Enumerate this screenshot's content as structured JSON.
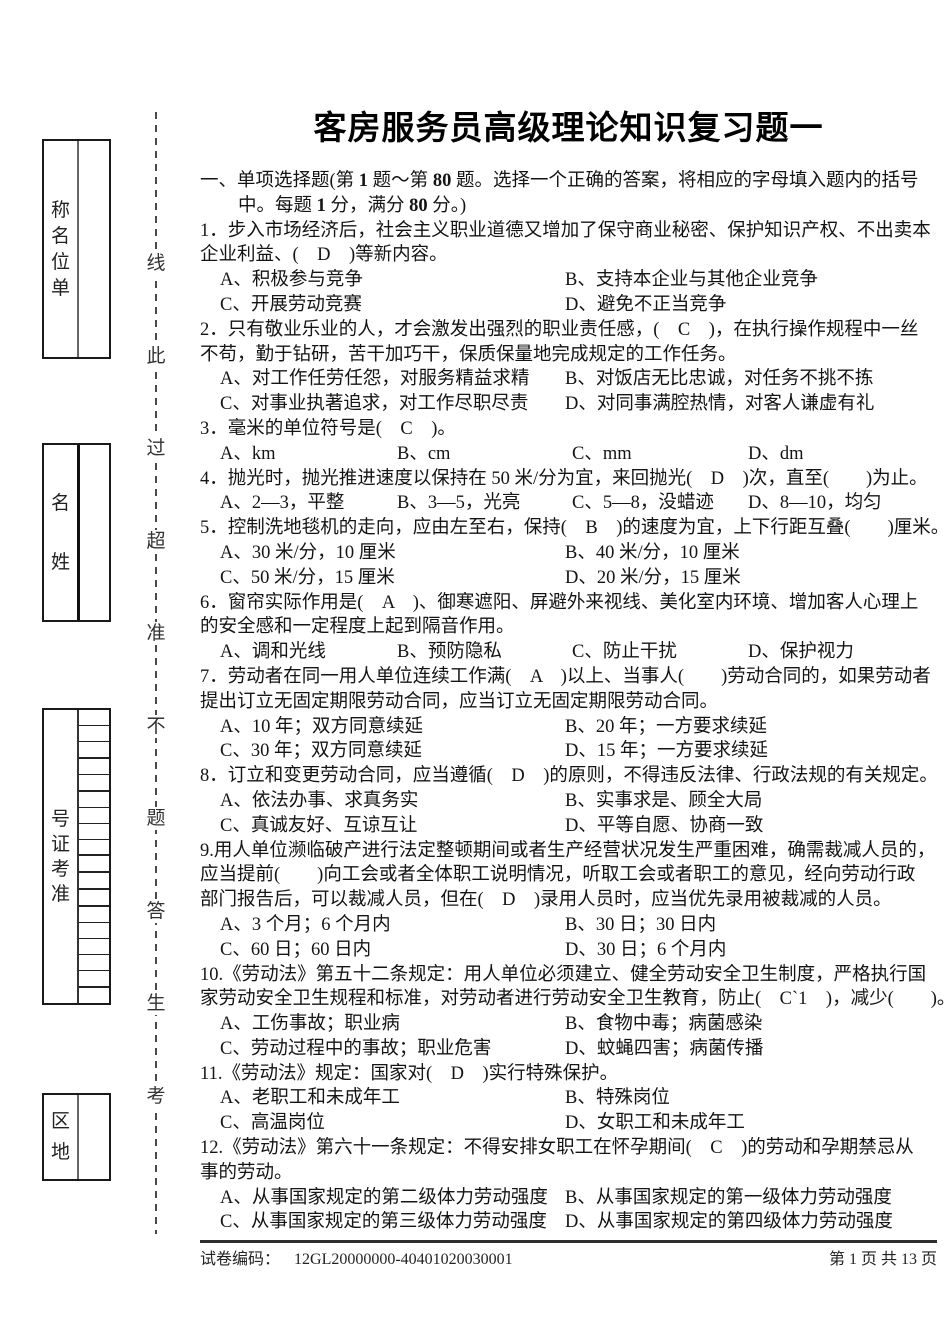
{
  "page": {
    "title": "客房服务员高级理论知识复习题一"
  },
  "section_header": {
    "line1": "一、单项选择题(第 1 题～第 80 题。选择一个正确的答案，将相应的字母填入题内的括号",
    "line2": "中。每题 1 分，满分 80 分。)"
  },
  "questions": [
    {
      "layout": "two",
      "stem_lines": [
        "1．步入市场经济后，社会主义职业道德又增加了保守商业秘密、保护知识产权、不出卖本",
        "企业利益、(　D　)等新内容。"
      ],
      "options": [
        "A、积极参与竞争",
        "B、支持本企业与其他企业竞争",
        "C、开展劳动竞赛",
        "D、避免不正当竞争"
      ]
    },
    {
      "layout": "two",
      "stem_lines": [
        "2．只有敬业乐业的人，才会激发出强烈的职业责任感，(　C　)，在执行操作规程中一丝",
        "不苟，勤于钻研，苦干加巧干，保质保量地完成规定的工作任务。"
      ],
      "options": [
        "A、对工作任劳任怨，对服务精益求精",
        "B、对饭店无比忠诚，对任务不挑不拣",
        "C、对事业执著追求，对工作尽职尽责",
        "D、对同事满腔热情，对客人谦虚有礼"
      ]
    },
    {
      "layout": "four",
      "stem_lines": [
        "3．毫米的单位符号是(　C　)。"
      ],
      "options": [
        "A、km",
        "B、cm",
        "C、mm",
        "D、dm"
      ]
    },
    {
      "layout": "four",
      "stem_lines": [
        "4．抛光时，抛光推进速度以保持在 50 米/分为宜，来回抛光(　D　)次，直至(　　)为止。"
      ],
      "options": [
        "A、2—3，平整",
        "B、3—5，光亮",
        "C、5—8，没蜡迹",
        "D、8—10，均匀"
      ]
    },
    {
      "layout": "two",
      "stem_lines": [
        "5．控制洗地毯机的走向，应由左至右，保持(　B　)的速度为宜，上下行距互叠(　　)厘米。"
      ],
      "options": [
        "A、30 米/分，10 厘米",
        "B、40 米/分，10 厘米",
        "C、50 米/分，15 厘米",
        "D、20 米/分，15 厘米"
      ]
    },
    {
      "layout": "four",
      "stem_lines": [
        "6．窗帘实际作用是(　A　)、御寒遮阳、屏避外来视线、美化室内环境、增加客人心理上",
        "的安全感和一定程度上起到隔音作用。"
      ],
      "options": [
        "A、调和光线",
        "B、预防隐私",
        "C、防止干扰",
        "D、保护视力"
      ]
    },
    {
      "layout": "two",
      "stem_lines": [
        "7．劳动者在同一用人单位连续工作满(　A　)以上、当事人(　　)劳动合同的，如果劳动者",
        "提出订立无固定期限劳动合同，应当订立无固定期限劳动合同。"
      ],
      "options": [
        "A、10 年；双方同意续延",
        "B、20 年；一方要求续延",
        "C、30 年；双方同意续延",
        "D、15 年；一方要求续延"
      ]
    },
    {
      "layout": "two",
      "stem_lines": [
        "8．订立和变更劳动合同，应当遵循(　D　)的原则，不得违反法律、行政法规的有关规定。"
      ],
      "options": [
        "A、依法办事、求真务实",
        "B、实事求是、顾全大局",
        "C、真诚友好、互谅互让",
        "D、平等自愿、协商一致"
      ]
    },
    {
      "layout": "two",
      "stem_lines": [
        "9.用人单位濒临破产进行法定整顿期间或者生产经营状况发生严重困难，确需裁减人员的，",
        "应当提前(　　)向工会或者全体职工说明情况，听取工会或者职工的意见，经向劳动行政",
        "部门报告后，可以裁减人员，但在(　D　)录用人员时，应当优先录用被裁减的人员。"
      ],
      "options": [
        "A、3 个月；6 个月内",
        "B、30 日；30 日内",
        "C、60 日；60 日内",
        "D、30 日；6 个月内"
      ]
    },
    {
      "layout": "two",
      "stem_lines": [
        "10.《劳动法》第五十二条规定：用人单位必须建立、健全劳动安全卫生制度，严格执行国",
        "家劳动安全卫生规程和标准，对劳动者进行劳动安全卫生教育，防止(　C`1　)，减少(　　)。"
      ],
      "options": [
        "A、工伤事故；职业病",
        "B、食物中毒；病菌感染",
        "C、劳动过程中的事故；职业危害",
        "D、蚊蝇四害；病菌传播"
      ]
    },
    {
      "layout": "two",
      "stem_lines": [
        "11.《劳动法》规定：国家对(　D　)实行特殊保护。"
      ],
      "options": [
        "A、老职工和未成年工",
        "B、特殊岗位",
        "C、高温岗位",
        "D、女职工和未成年工"
      ]
    },
    {
      "layout": "two",
      "stem_lines": [
        "12.《劳动法》第六十一条规定：不得安排女职工在怀孕期间(　C　)的劳动和孕期禁忌从",
        "事的劳动。"
      ],
      "options": [
        "A、从事国家规定的第二级体力劳动强度",
        "B、从事国家规定的第一级体力劳动强度",
        "C、从事国家规定的第三级体力劳动强度",
        "D、从事国家规定的第四级体力劳动强度"
      ]
    }
  ],
  "sidebar": {
    "boxes": [
      {
        "id": "unit-name",
        "chars": [
          "称",
          "名",
          "位",
          "单"
        ]
      },
      {
        "id": "name",
        "chars": [
          "名",
          "姓"
        ]
      },
      {
        "id": "exam-number",
        "chars": [
          "号",
          "证",
          "考",
          "准"
        ],
        "cells": 18,
        "thick_after": [
          3,
          5,
          9,
          10,
          11,
          12,
          17
        ]
      },
      {
        "id": "district",
        "chars": [
          "区",
          "地"
        ]
      }
    ],
    "cutline_chars": [
      "线",
      "此",
      "过",
      "超",
      "准",
      "不",
      "题",
      "答",
      "生",
      "考"
    ]
  },
  "footer": {
    "paper_code_label": "试卷编码：",
    "paper_code": "12GL20000000-40401020030001",
    "page_info": "第 1 页  共 13 页"
  }
}
